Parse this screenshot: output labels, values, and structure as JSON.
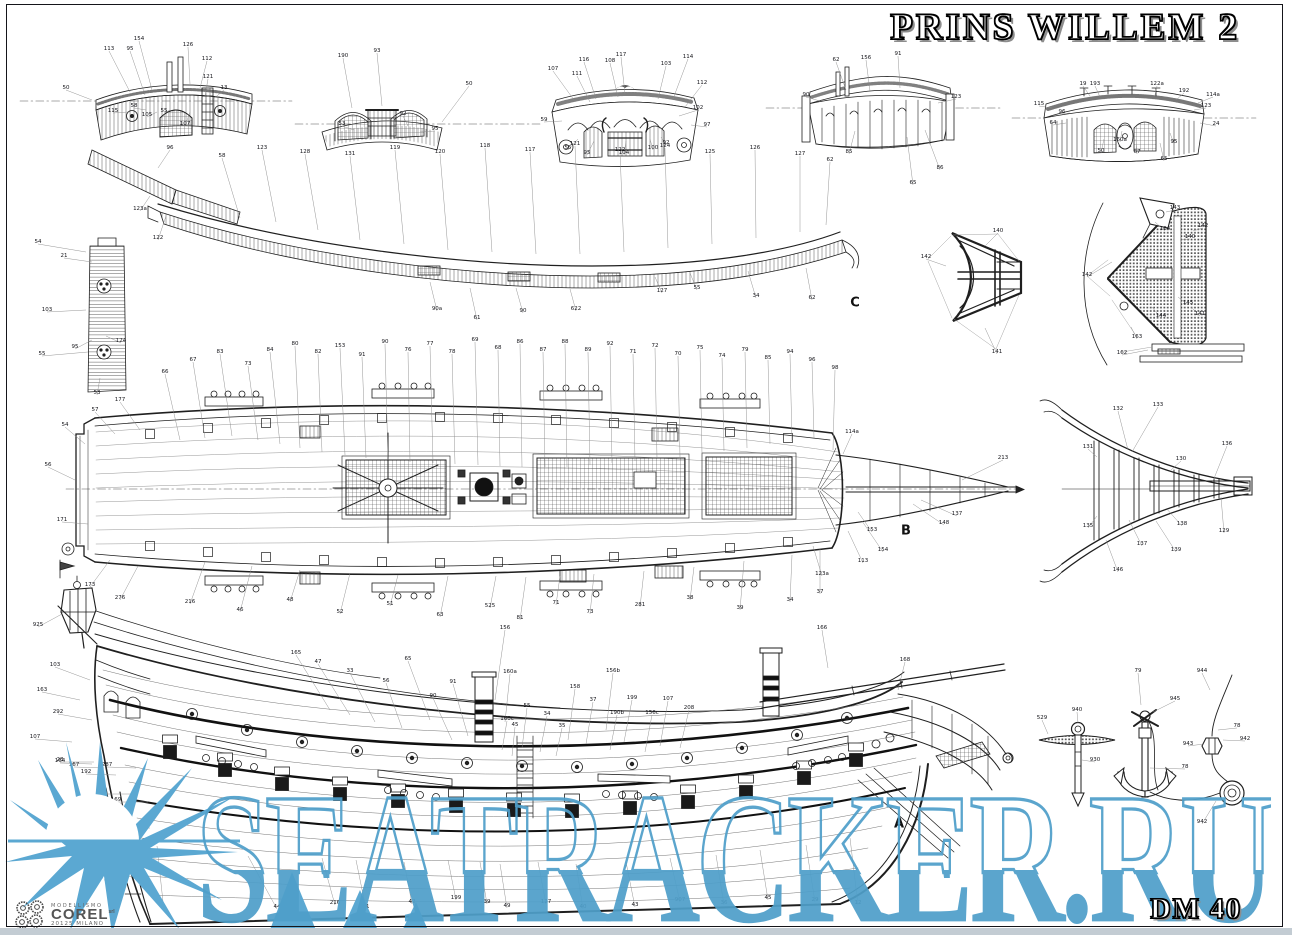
{
  "sheet": {
    "title": "PRINS WILLEM 2",
    "sheet_number": "DM 40",
    "section_labels": [
      {
        "t": "C",
        "x": 855,
        "y": 303
      },
      {
        "t": "B",
        "x": 906,
        "y": 531
      },
      {
        "t": "A",
        "x": 899,
        "y": 824
      }
    ]
  },
  "logo": {
    "line1": "MODELLISMO",
    "name": "COREL",
    "suffix": "srl",
    "line3": "20125 MILANO"
  },
  "watermark": {
    "text": "SEATRACKER.RU",
    "color": "#4f9fca"
  },
  "callouts": [
    [
      109,
      49,
      "113",
      130,
      92
    ],
    [
      130,
      49,
      "95",
      145,
      95
    ],
    [
      139,
      39,
      "154",
      152,
      90
    ],
    [
      188,
      45,
      "126",
      190,
      84
    ],
    [
      207,
      59,
      "112",
      200,
      88
    ],
    [
      208,
      77,
      "121",
      205,
      96
    ],
    [
      224,
      88,
      "13",
      212,
      100
    ],
    [
      66,
      88,
      "50",
      92,
      100
    ],
    [
      113,
      111,
      "115",
      128,
      112
    ],
    [
      134,
      106,
      "58",
      146,
      110
    ],
    [
      147,
      115,
      "105",
      157,
      112
    ],
    [
      164,
      111,
      "55",
      170,
      110
    ],
    [
      185,
      124,
      "107",
      190,
      112
    ],
    [
      343,
      56,
      "190",
      352,
      108
    ],
    [
      377,
      51,
      "93",
      382,
      106
    ],
    [
      342,
      124,
      "53",
      354,
      130
    ],
    [
      403,
      114,
      "92",
      408,
      126
    ],
    [
      469,
      84,
      "50",
      442,
      122
    ],
    [
      435,
      129,
      "95",
      420,
      132
    ],
    [
      553,
      69,
      "107",
      574,
      100
    ],
    [
      577,
      74,
      "111",
      590,
      102
    ],
    [
      584,
      60,
      "116",
      596,
      99
    ],
    [
      610,
      61,
      "108",
      618,
      97
    ],
    [
      621,
      55,
      "117",
      625,
      94
    ],
    [
      666,
      64,
      "103",
      658,
      99
    ],
    [
      688,
      57,
      "114",
      673,
      99
    ],
    [
      702,
      83,
      "112",
      685,
      107
    ],
    [
      698,
      108,
      "102",
      679,
      116
    ],
    [
      544,
      120,
      "59",
      562,
      121
    ],
    [
      568,
      148,
      "55",
      578,
      139
    ],
    [
      587,
      153,
      "95",
      594,
      141
    ],
    [
      624,
      153,
      "104",
      626,
      141
    ],
    [
      653,
      148,
      "100",
      650,
      139
    ],
    [
      666,
      143,
      "92",
      661,
      137
    ],
    [
      707,
      125,
      "97",
      691,
      125
    ],
    [
      836,
      60,
      "62",
      846,
      90
    ],
    [
      866,
      58,
      "156",
      870,
      91
    ],
    [
      898,
      54,
      "91",
      900,
      88
    ],
    [
      956,
      97,
      "123",
      938,
      103
    ],
    [
      806,
      95,
      "90",
      820,
      101
    ],
    [
      849,
      152,
      "85",
      855,
      131
    ],
    [
      913,
      183,
      "65",
      907,
      137
    ],
    [
      940,
      168,
      "86",
      925,
      130
    ],
    [
      1083,
      84,
      "19",
      1090,
      96
    ],
    [
      1095,
      84,
      "193",
      1100,
      97
    ],
    [
      1157,
      84,
      "122a",
      1155,
      95
    ],
    [
      1184,
      91,
      "192",
      1176,
      100
    ],
    [
      1213,
      95,
      "114a",
      1198,
      103
    ],
    [
      1039,
      104,
      "115",
      1052,
      108
    ],
    [
      1062,
      112,
      "96",
      1070,
      113
    ],
    [
      1053,
      123,
      "64",
      1066,
      123
    ],
    [
      1206,
      106,
      "123",
      1194,
      110
    ],
    [
      1216,
      124,
      "24",
      1200,
      123
    ],
    [
      1101,
      151,
      "50",
      1104,
      139
    ],
    [
      1120,
      140,
      "160a",
      1122,
      131
    ],
    [
      1137,
      152,
      "67",
      1136,
      139
    ],
    [
      1174,
      142,
      "95",
      1170,
      133
    ],
    [
      1164,
      159,
      "65",
      1160,
      143
    ],
    [
      38,
      242,
      "54",
      86,
      252
    ],
    [
      64,
      256,
      "21",
      92,
      262
    ],
    [
      47,
      310,
      "103",
      86,
      310
    ],
    [
      75,
      347,
      "95",
      92,
      340
    ],
    [
      42,
      354,
      "55",
      88,
      352
    ],
    [
      121,
      341,
      "124",
      106,
      336
    ],
    [
      97,
      393,
      "53",
      100,
      378
    ],
    [
      170,
      148,
      "96",
      158,
      168
    ],
    [
      140,
      209,
      "123a",
      150,
      196
    ],
    [
      158,
      238,
      "122",
      166,
      216
    ],
    [
      222,
      156,
      "58",
      240,
      218
    ],
    [
      262,
      148,
      "123",
      276,
      222
    ],
    [
      305,
      152,
      "128",
      318,
      230
    ],
    [
      350,
      154,
      "131",
      360,
      240
    ],
    [
      395,
      148,
      "119",
      404,
      244
    ],
    [
      440,
      152,
      "120",
      448,
      250
    ],
    [
      485,
      146,
      "118",
      492,
      252
    ],
    [
      530,
      150,
      "117",
      536,
      254
    ],
    [
      575,
      144,
      "121",
      580,
      254
    ],
    [
      620,
      150,
      "122",
      624,
      252
    ],
    [
      665,
      146,
      "124",
      668,
      248
    ],
    [
      710,
      152,
      "125",
      712,
      244
    ],
    [
      755,
      148,
      "126",
      756,
      238
    ],
    [
      800,
      154,
      "127",
      800,
      232
    ],
    [
      830,
      160,
      "62",
      826,
      225
    ],
    [
      437,
      309,
      "90a",
      430,
      282
    ],
    [
      477,
      318,
      "61",
      470,
      288
    ],
    [
      523,
      311,
      "90",
      516,
      288
    ],
    [
      576,
      309,
      "622",
      570,
      289
    ],
    [
      662,
      291,
      "127",
      655,
      277
    ],
    [
      756,
      296,
      "34",
      748,
      271
    ],
    [
      812,
      298,
      "62",
      806,
      268
    ],
    [
      697,
      288,
      "55",
      690,
      273
    ],
    [
      998,
      231,
      "140",
      985,
      246
    ],
    [
      926,
      257,
      "142",
      946,
      266
    ],
    [
      997,
      352,
      "141",
      985,
      328
    ],
    [
      1175,
      208,
      "143",
      1166,
      212
    ],
    [
      1165,
      229,
      "164",
      1155,
      222
    ],
    [
      1203,
      226,
      "142",
      1193,
      231
    ],
    [
      1190,
      237,
      "140",
      1180,
      240
    ],
    [
      1087,
      275,
      "142",
      1112,
      262
    ],
    [
      1188,
      303,
      "145",
      1178,
      297
    ],
    [
      1161,
      316,
      "144",
      1152,
      307
    ],
    [
      1200,
      314,
      "141",
      1191,
      307
    ],
    [
      1137,
      337,
      "163",
      1131,
      327
    ],
    [
      1122,
      353,
      "162",
      1148,
      350
    ],
    [
      1118,
      409,
      "132",
      1128,
      450
    ],
    [
      1158,
      405,
      "133",
      1132,
      452
    ],
    [
      1181,
      459,
      "130",
      1171,
      470
    ],
    [
      1227,
      444,
      "136",
      1213,
      481
    ],
    [
      1224,
      531,
      "129",
      1221,
      497
    ],
    [
      1182,
      524,
      "138",
      1166,
      508
    ],
    [
      1142,
      544,
      "137",
      1129,
      520
    ],
    [
      1176,
      550,
      "139",
      1156,
      521
    ],
    [
      1118,
      570,
      "146",
      1106,
      540
    ],
    [
      1088,
      447,
      "131",
      1097,
      457
    ],
    [
      1088,
      526,
      "135",
      1097,
      516
    ],
    [
      165,
      372,
      "66",
      180,
      440
    ],
    [
      193,
      360,
      "67",
      205,
      438
    ],
    [
      220,
      352,
      "83",
      232,
      436
    ],
    [
      248,
      364,
      "73",
      258,
      440
    ],
    [
      270,
      350,
      "84",
      280,
      444
    ],
    [
      295,
      344,
      "80",
      300,
      448
    ],
    [
      318,
      352,
      "82",
      322,
      452
    ],
    [
      340,
      346,
      "153",
      345,
      455
    ],
    [
      362,
      355,
      "91",
      366,
      458
    ],
    [
      385,
      342,
      "90",
      388,
      460
    ],
    [
      408,
      350,
      "76",
      410,
      462
    ],
    [
      430,
      344,
      "77",
      433,
      463
    ],
    [
      452,
      352,
      "78",
      455,
      464
    ],
    [
      475,
      340,
      "69",
      478,
      465
    ],
    [
      498,
      348,
      "68",
      500,
      466
    ],
    [
      520,
      342,
      "86",
      522,
      467
    ],
    [
      543,
      350,
      "87",
      545,
      467
    ],
    [
      565,
      342,
      "88",
      567,
      467
    ],
    [
      588,
      350,
      "89",
      590,
      465
    ],
    [
      610,
      344,
      "92",
      612,
      463
    ],
    [
      633,
      352,
      "71",
      635,
      461
    ],
    [
      655,
      346,
      "72",
      657,
      459
    ],
    [
      678,
      354,
      "70",
      680,
      457
    ],
    [
      700,
      348,
      "75",
      702,
      454
    ],
    [
      722,
      356,
      "74",
      724,
      451
    ],
    [
      745,
      350,
      "79",
      747,
      448
    ],
    [
      768,
      358,
      "85",
      770,
      444
    ],
    [
      790,
      352,
      "94",
      792,
      441
    ],
    [
      812,
      360,
      "96",
      814,
      438
    ],
    [
      835,
      368,
      "98",
      833,
      450
    ],
    [
      120,
      400,
      "177",
      140,
      430
    ],
    [
      95,
      410,
      "57",
      115,
      434
    ],
    [
      65,
      425,
      "54",
      85,
      444
    ],
    [
      48,
      465,
      "56",
      75,
      480
    ],
    [
      62,
      520,
      "171",
      88,
      524
    ],
    [
      90,
      585,
      "173",
      110,
      560
    ],
    [
      120,
      598,
      "276",
      138,
      566
    ],
    [
      190,
      602,
      "216",
      205,
      562
    ],
    [
      240,
      610,
      "46",
      252,
      566
    ],
    [
      290,
      600,
      "48",
      300,
      570
    ],
    [
      340,
      612,
      "52",
      350,
      573
    ],
    [
      390,
      604,
      "51",
      398,
      575
    ],
    [
      440,
      615,
      "63",
      448,
      576
    ],
    [
      490,
      606,
      "525",
      496,
      576
    ],
    [
      520,
      618,
      "81",
      526,
      577
    ],
    [
      556,
      603,
      "71",
      560,
      576
    ],
    [
      590,
      612,
      "73",
      594,
      574
    ],
    [
      640,
      605,
      "281",
      644,
      571
    ],
    [
      690,
      598,
      "38",
      694,
      567
    ],
    [
      740,
      608,
      "39",
      744,
      561
    ],
    [
      790,
      600,
      "34",
      792,
      555
    ],
    [
      820,
      592,
      "37",
      820,
      549
    ],
    [
      957,
      514,
      "137",
      921,
      500
    ],
    [
      944,
      523,
      "148",
      913,
      504
    ],
    [
      872,
      530,
      "153",
      858,
      512
    ],
    [
      883,
      550,
      "154",
      862,
      521
    ],
    [
      863,
      561,
      "113",
      848,
      531
    ],
    [
      1003,
      458,
      "213",
      962,
      480
    ],
    [
      852,
      432,
      "114a",
      843,
      454
    ],
    [
      822,
      574,
      "123a",
      813,
      546
    ],
    [
      296,
      653,
      "165",
      330,
      710
    ],
    [
      318,
      662,
      "47",
      350,
      715
    ],
    [
      350,
      671,
      "33",
      375,
      722
    ],
    [
      386,
      681,
      "56",
      402,
      728
    ],
    [
      408,
      659,
      "65",
      430,
      720
    ],
    [
      433,
      696,
      "90",
      452,
      740
    ],
    [
      453,
      682,
      "91",
      468,
      736
    ],
    [
      505,
      628,
      "156",
      495,
      700
    ],
    [
      510,
      672,
      "160a",
      505,
      722
    ],
    [
      507,
      719,
      "160c",
      502,
      750
    ],
    [
      515,
      725,
      "45",
      512,
      756
    ],
    [
      527,
      706,
      "55",
      522,
      748
    ],
    [
      547,
      714,
      "34",
      540,
      752
    ],
    [
      562,
      726,
      "35",
      556,
      756
    ],
    [
      575,
      687,
      "158",
      568,
      740
    ],
    [
      593,
      700,
      "37",
      586,
      744
    ],
    [
      613,
      671,
      "156b",
      606,
      730
    ],
    [
      632,
      698,
      "199",
      624,
      742
    ],
    [
      617,
      713,
      "190b",
      610,
      750
    ],
    [
      652,
      713,
      "156c",
      645,
      752
    ],
    [
      668,
      699,
      "107",
      660,
      746
    ],
    [
      689,
      708,
      "208",
      680,
      748
    ],
    [
      822,
      628,
      "166",
      828,
      668
    ],
    [
      905,
      660,
      "168",
      898,
      690
    ],
    [
      38,
      625,
      "925",
      62,
      614
    ],
    [
      55,
      665,
      "103",
      90,
      680
    ],
    [
      42,
      690,
      "163",
      80,
      700
    ],
    [
      58,
      712,
      "292",
      92,
      720
    ],
    [
      35,
      737,
      "107",
      72,
      742
    ],
    [
      60,
      760,
      "28",
      94,
      762
    ],
    [
      277,
      907,
      "44",
      248,
      856
    ],
    [
      335,
      903,
      "216",
      322,
      858
    ],
    [
      366,
      907,
      "41",
      356,
      860
    ],
    [
      412,
      902,
      "42",
      404,
      862
    ],
    [
      456,
      898,
      "199",
      448,
      860
    ],
    [
      487,
      902,
      "39",
      480,
      862
    ],
    [
      507,
      906,
      "49",
      500,
      864
    ],
    [
      546,
      902,
      "127",
      538,
      862
    ],
    [
      583,
      907,
      "40",
      576,
      864
    ],
    [
      635,
      905,
      "43",
      626,
      862
    ],
    [
      680,
      900,
      "907",
      670,
      858
    ],
    [
      724,
      903,
      "36",
      716,
      855
    ],
    [
      768,
      898,
      "45",
      760,
      850
    ],
    [
      815,
      900,
      "29",
      806,
      845
    ],
    [
      858,
      903,
      "12",
      850,
      838
    ],
    [
      164,
      909,
      "1",
      157,
      846
    ],
    [
      116,
      857,
      "173",
      146,
      858
    ],
    [
      117,
      851,
      "171",
      148,
      850
    ],
    [
      89,
      857,
      "172",
      120,
      858
    ],
    [
      104,
      878,
      "79",
      134,
      876
    ],
    [
      117,
      827,
      "175",
      150,
      828
    ],
    [
      102,
      792,
      "176",
      136,
      794
    ],
    [
      116,
      800,
      "169",
      148,
      802
    ],
    [
      74,
      765,
      "167",
      104,
      768
    ],
    [
      60,
      761,
      "164",
      92,
      764
    ],
    [
      86,
      772,
      "192",
      116,
      775
    ],
    [
      107,
      765,
      "287",
      136,
      768
    ],
    [
      1042,
      718,
      "529",
      1048,
      734
    ],
    [
      1077,
      710,
      "940",
      1078,
      723
    ],
    [
      1095,
      760,
      "930",
      1082,
      760
    ],
    [
      1138,
      671,
      "79",
      1141,
      705
    ],
    [
      1175,
      699,
      "945",
      1153,
      712
    ],
    [
      1185,
      767,
      "78",
      1150,
      768
    ],
    [
      1202,
      671,
      "944",
      1210,
      690
    ],
    [
      1237,
      726,
      "78",
      1218,
      730
    ],
    [
      1245,
      739,
      "942",
      1223,
      740
    ],
    [
      1188,
      744,
      "943",
      1204,
      744
    ],
    [
      1202,
      822,
      "942",
      1216,
      801
    ]
  ]
}
